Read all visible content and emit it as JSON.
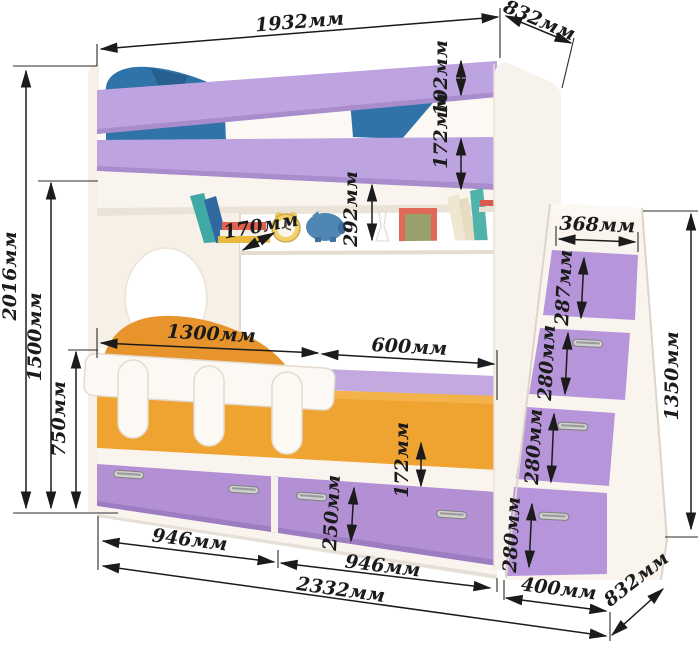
{
  "palette": {
    "background": "#ffffff",
    "furniture_white": "#f9f4ee",
    "cream_shadow": "#efe6db",
    "rail_lilac": "#bda4e0",
    "rail_lilac_shade": "#a98ccb",
    "drawer_purple": "#b290d3",
    "step_purple": "#b795da",
    "mattress_orange": "#efa331",
    "pillow_orange": "#e8942d",
    "pillow_blue": "#3073a9",
    "dimension_ink": "#1b1b1b"
  },
  "unit": "мм",
  "dimensions": {
    "top_length": "1932мм",
    "top_depth": "832мм",
    "upper_rail_height": "102мм",
    "lower_rail_height": "172мм",
    "total_height": "2016мм",
    "upper_bed_height": "1500мм",
    "guard_rail_height": "750мм",
    "shelf_depth": "170мм",
    "shelf_opening_height": "292мм",
    "bed_section_length": "1300мм",
    "end_section_length": "600мм",
    "stair_top_width": "368мм",
    "step1_height": "287мм",
    "step2_height": "280мм",
    "stair_total_height": "1350мм",
    "step3_height": "280мм",
    "step4_height": "280мм",
    "base_panel_height": "172мм",
    "drawer_height": "250мм",
    "left_drawer_width": "946мм",
    "right_drawer_width": "946мм",
    "total_length": "2332мм",
    "stair_footprint_width": "400мм",
    "bottom_depth": "832мм"
  }
}
